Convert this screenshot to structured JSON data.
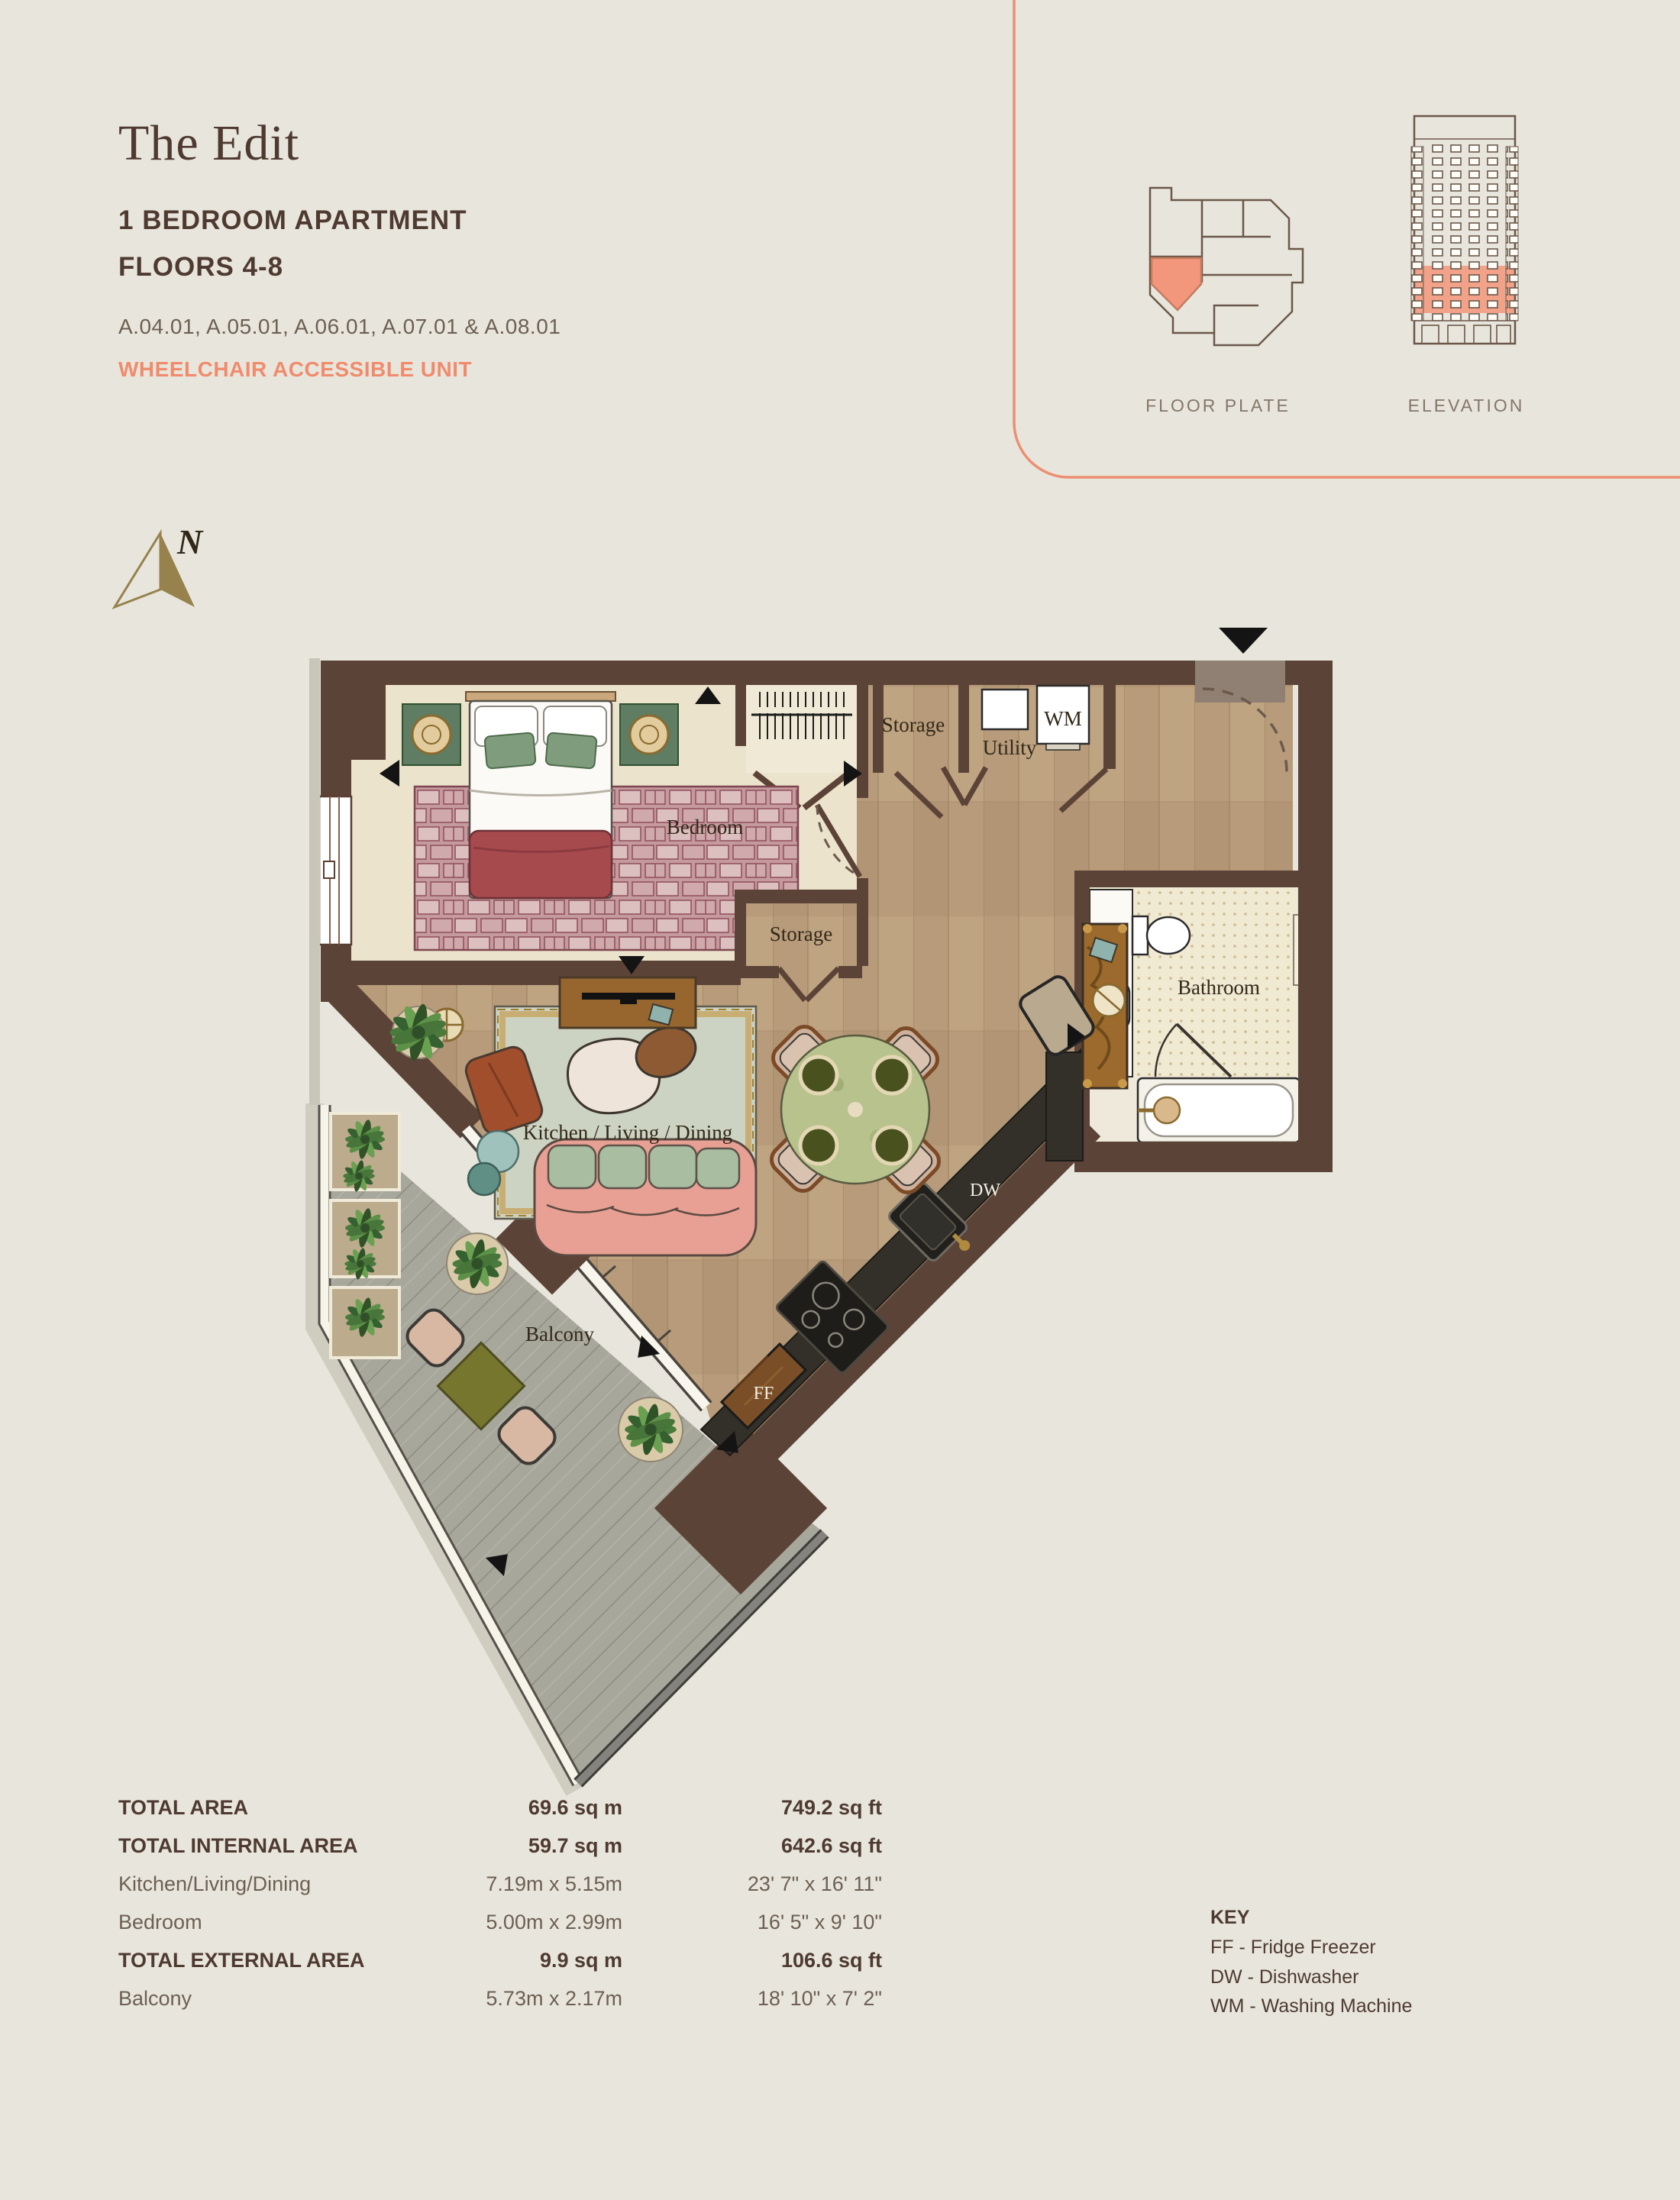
{
  "header": {
    "title": "The Edit",
    "type_line1": "1 BEDROOM APARTMENT",
    "type_line2": "FLOORS 4-8",
    "units": "A.04.01, A.05.01, A.06.01, A.07.01 & A.08.01",
    "accessibility": "WHEELCHAIR ACCESSIBLE UNIT"
  },
  "panel": {
    "floor_plate_label": "FLOOR PLATE",
    "elevation_label": "ELEVATION"
  },
  "compass": {
    "north": "N"
  },
  "plan": {
    "labels": {
      "bedroom": "Bedroom",
      "storage_top": "Storage",
      "utility": "Utility",
      "wm": "WM",
      "storage_mid": "Storage",
      "bathroom": "Bathroom",
      "kld": "Kitchen / Living / Dining",
      "dw": "DW",
      "ff": "FF",
      "balcony": "Balcony"
    }
  },
  "stats": {
    "rows": [
      {
        "label": "TOTAL AREA",
        "metric": "69.6 sq m",
        "imperial": "749.2 sq ft",
        "bold": true
      },
      {
        "label": "TOTAL INTERNAL AREA",
        "metric": "59.7 sq m",
        "imperial": "642.6 sq ft",
        "bold": true
      },
      {
        "label": "Kitchen/Living/Dining",
        "metric": "7.19m x 5.15m",
        "imperial": "23' 7\" x 16' 11\"",
        "bold": false
      },
      {
        "label": "Bedroom",
        "metric": "5.00m x 2.99m",
        "imperial": "16' 5\" x 9' 10\"",
        "bold": false
      },
      {
        "label": "TOTAL EXTERNAL AREA",
        "metric": "9.9 sq m",
        "imperial": "106.6 sq ft",
        "bold": true
      },
      {
        "label": "Balcony",
        "metric": "5.73m x 2.17m",
        "imperial": "18' 10\" x 7' 2\"",
        "bold": false
      }
    ]
  },
  "key": {
    "title": "KEY",
    "items": [
      "FF - Fridge Freezer",
      "DW - Dishwasher",
      "WM - Washing Machine"
    ]
  },
  "colors": {
    "background": "#e8e6dc",
    "accent_salmon": "#f08b6d",
    "wall_brown": "#5c4337",
    "text_brown": "#4e3a31",
    "wood_floor": "#b79b7a",
    "bedroom_floor": "#ece3cc",
    "balcony_deck": "#a8a79b",
    "counter_dark": "#33302a",
    "compass_gold": "#97824e"
  }
}
